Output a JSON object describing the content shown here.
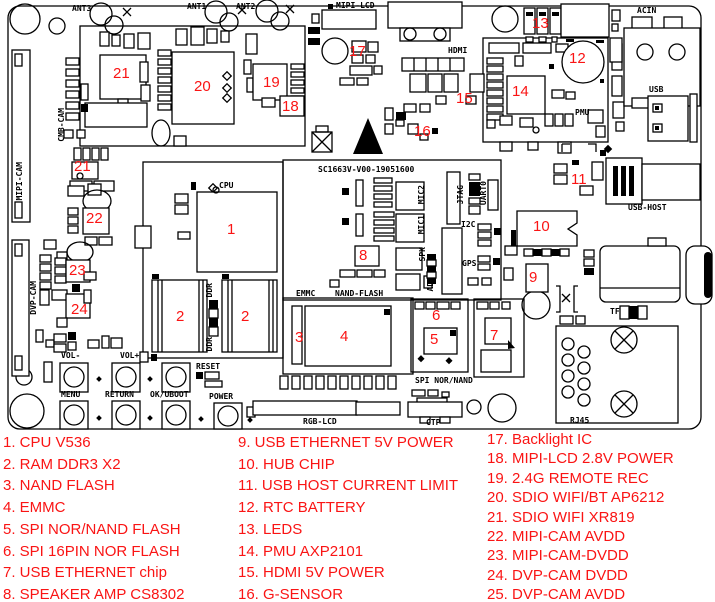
{
  "colors": {
    "marker_red": "#fa1414",
    "silkscreen": "#000000",
    "board_bg": "#ffffff"
  },
  "board": {
    "id_text": "SC1663V-V00-19051600",
    "silkscreen": [
      {
        "text": "ANT3",
        "x": 72,
        "y": 5
      },
      {
        "text": "ANT1",
        "x": 187,
        "y": 3
      },
      {
        "text": "ANT2",
        "x": 236,
        "y": 3
      },
      {
        "text": "MIPI-LCD",
        "x": 336,
        "y": 2
      },
      {
        "text": "ACIN",
        "x": 637,
        "y": 7
      },
      {
        "text": "HDMI",
        "x": 448,
        "y": 47
      },
      {
        "text": "USB",
        "x": 649,
        "y": 86
      },
      {
        "text": "PMU",
        "x": 575,
        "y": 109
      },
      {
        "text": "USB-HOST",
        "x": 628,
        "y": 204
      },
      {
        "text": "CPU",
        "x": 219,
        "y": 182
      },
      {
        "text": "SC1663V-V00-19051600",
        "x": 318,
        "y": 166
      },
      {
        "text": "EMMC",
        "x": 296,
        "y": 290
      },
      {
        "text": "NAND-FLASH",
        "x": 335,
        "y": 290
      },
      {
        "text": "SPI NOR/NAND",
        "x": 415,
        "y": 377
      },
      {
        "text": "CTP",
        "x": 426,
        "y": 419
      },
      {
        "text": "RGB-LCD",
        "x": 303,
        "y": 418
      },
      {
        "text": "TF",
        "x": 610,
        "y": 308
      },
      {
        "text": "RJ45",
        "x": 570,
        "y": 417
      },
      {
        "text": "I2C",
        "x": 461,
        "y": 221
      },
      {
        "text": "GPS",
        "x": 462,
        "y": 260
      },
      {
        "text": "VOL-",
        "x": 61,
        "y": 352
      },
      {
        "text": "VOL+",
        "x": 120,
        "y": 352
      },
      {
        "text": "RESET",
        "x": 196,
        "y": 363
      },
      {
        "text": "MENU",
        "x": 61,
        "y": 391
      },
      {
        "text": "RETURN",
        "x": 105,
        "y": 391
      },
      {
        "text": "OK/UBOOT",
        "x": 150,
        "y": 391
      },
      {
        "text": "POWER",
        "x": 209,
        "y": 393
      },
      {
        "text": "MIPI-CAM",
        "x": 16,
        "y": 162,
        "v": true
      },
      {
        "text": "CMB-CAM",
        "x": 58,
        "y": 108,
        "v": true
      },
      {
        "text": "DVP-CAM",
        "x": 30,
        "y": 281,
        "v": true
      },
      {
        "text": "MIC2",
        "x": 418,
        "y": 185,
        "v": true
      },
      {
        "text": "MIC1",
        "x": 418,
        "y": 215,
        "v": true
      },
      {
        "text": "SPK",
        "x": 419,
        "y": 247,
        "v": true
      },
      {
        "text": "ADC",
        "x": 427,
        "y": 277,
        "v": true
      },
      {
        "text": "JTAG",
        "x": 457,
        "y": 185,
        "v": true
      },
      {
        "text": "UART0",
        "x": 480,
        "y": 181,
        "v": true
      },
      {
        "text": "DDR",
        "x": 206,
        "y": 283,
        "v": true
      },
      {
        "text": "DDR",
        "x": 206,
        "y": 337,
        "v": true
      }
    ],
    "markers": [
      {
        "n": "1",
        "x": 227,
        "y": 222
      },
      {
        "n": "2",
        "x": 176,
        "y": 309
      },
      {
        "n": "2",
        "x": 241,
        "y": 309
      },
      {
        "n": "3",
        "x": 295,
        "y": 330
      },
      {
        "n": "4",
        "x": 340,
        "y": 329
      },
      {
        "n": "5",
        "x": 430,
        "y": 332
      },
      {
        "n": "6",
        "x": 432,
        "y": 308
      },
      {
        "n": "7",
        "x": 490,
        "y": 328
      },
      {
        "n": "8",
        "x": 359,
        "y": 248
      },
      {
        "n": "9",
        "x": 529,
        "y": 270
      },
      {
        "n": "10",
        "x": 533,
        "y": 219
      },
      {
        "n": "11",
        "x": 571,
        "y": 172
      },
      {
        "n": "12",
        "x": 569,
        "y": 51
      },
      {
        "n": "13",
        "x": 532,
        "y": 16
      },
      {
        "n": "14",
        "x": 512,
        "y": 84
      },
      {
        "n": "15",
        "x": 456,
        "y": 91
      },
      {
        "n": "16",
        "x": 414,
        "y": 124
      },
      {
        "n": "17",
        "x": 349,
        "y": 44
      },
      {
        "n": "18",
        "x": 282,
        "y": 99
      },
      {
        "n": "19",
        "x": 263,
        "y": 75
      },
      {
        "n": "20",
        "x": 194,
        "y": 79
      },
      {
        "n": "21",
        "x": 113,
        "y": 66
      },
      {
        "n": "21",
        "x": 74,
        "y": 159
      },
      {
        "n": "22",
        "x": 86,
        "y": 211
      },
      {
        "n": "23",
        "x": 69,
        "y": 263
      },
      {
        "n": "24",
        "x": 71,
        "y": 302
      }
    ]
  },
  "legend": {
    "columns": [
      {
        "items": [
          "1. CPU V536",
          "2. RAM DDR3 X2",
          "3. NAND FLASH",
          "4. EMMC",
          "5. SPI NOR/NAND FLASH",
          "6. SPI 16PIN NOR FLASH",
          "7. USB ETHERNET chip",
          "8. SPEAKER AMP CS8302"
        ]
      },
      {
        "items": [
          "9. USB ETHERNET 5V POWER",
          "10. HUB CHIP",
          "11. USB HOST CURRENT LIMIT",
          "12. RTC BATTERY",
          "13. LEDS",
          "14. PMU AXP2101",
          "15. HDMI 5V POWER",
          "16. G-SENSOR"
        ]
      },
      {
        "items": [
          "17. Backlight IC",
          "18. MIPI-LCD 2.8V POWER",
          "19. 2.4G REMOTE REC",
          "20. SDIO WIFI/BT AP6212",
          "21. SDIO WIFI XR819",
          "22. MIPI-CAM AVDD",
          "23. MIPI-CAM-DVDD",
          "24. DVP-CAM DVDD",
          "25. DVP-CAM AVDD"
        ]
      }
    ]
  }
}
